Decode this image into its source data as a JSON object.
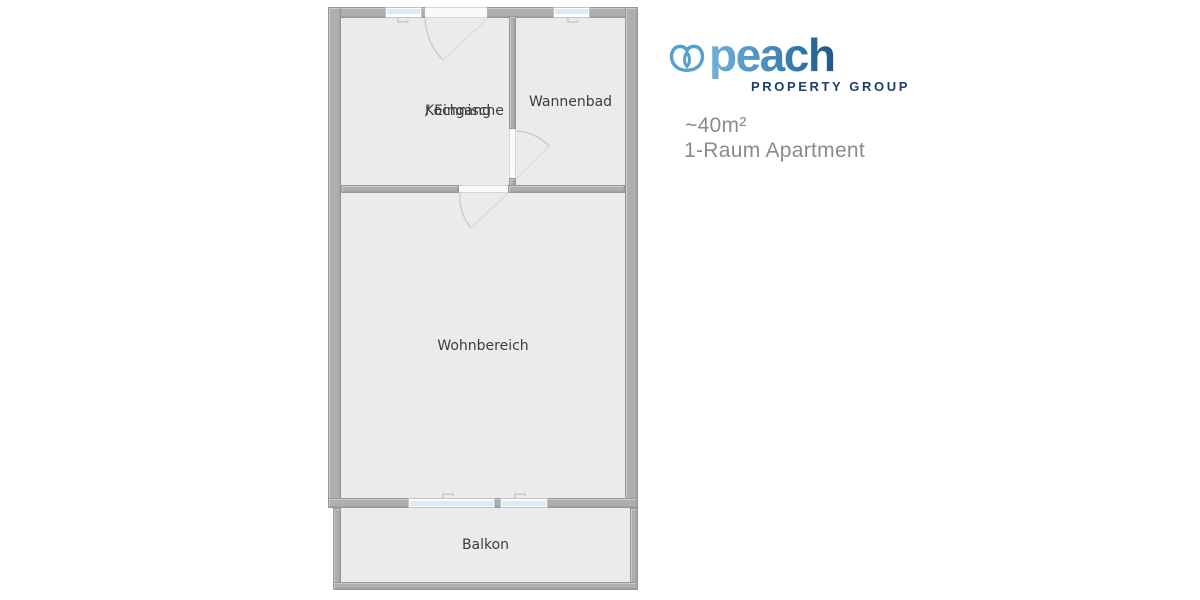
{
  "floorplan": {
    "name": "1-room-apartment-floorplan",
    "rooms": {
      "kochnische": {
        "line1": "Kochnische",
        "line2": "/ Eingang"
      },
      "wannenbad": {
        "label": "Wannenbad"
      },
      "wohnbereich": {
        "label": "Wohnbereich"
      },
      "balkon": {
        "label": "Balkon"
      }
    },
    "colors": {
      "wall": "#aeaeae",
      "room_fill": "#ebebeb",
      "window_glass": "#d9ebf4",
      "door_arc": "#c9c9c9",
      "label_text": "#3d3d3d"
    }
  },
  "branding": {
    "wordmark": "peach",
    "tagline": "PROPERTY GROUP",
    "icon": "peach-logo-icon",
    "colors": {
      "icon_blue": "#55a0cd",
      "gradient_start": "#72b1d7",
      "gradient_end": "#1b5a8c",
      "tagline_navy": "#1d3e6c",
      "detail_gray": "#8b8b8b"
    }
  },
  "details": {
    "area": "~40m²",
    "apartment_type": "1-Raum Apartment"
  }
}
